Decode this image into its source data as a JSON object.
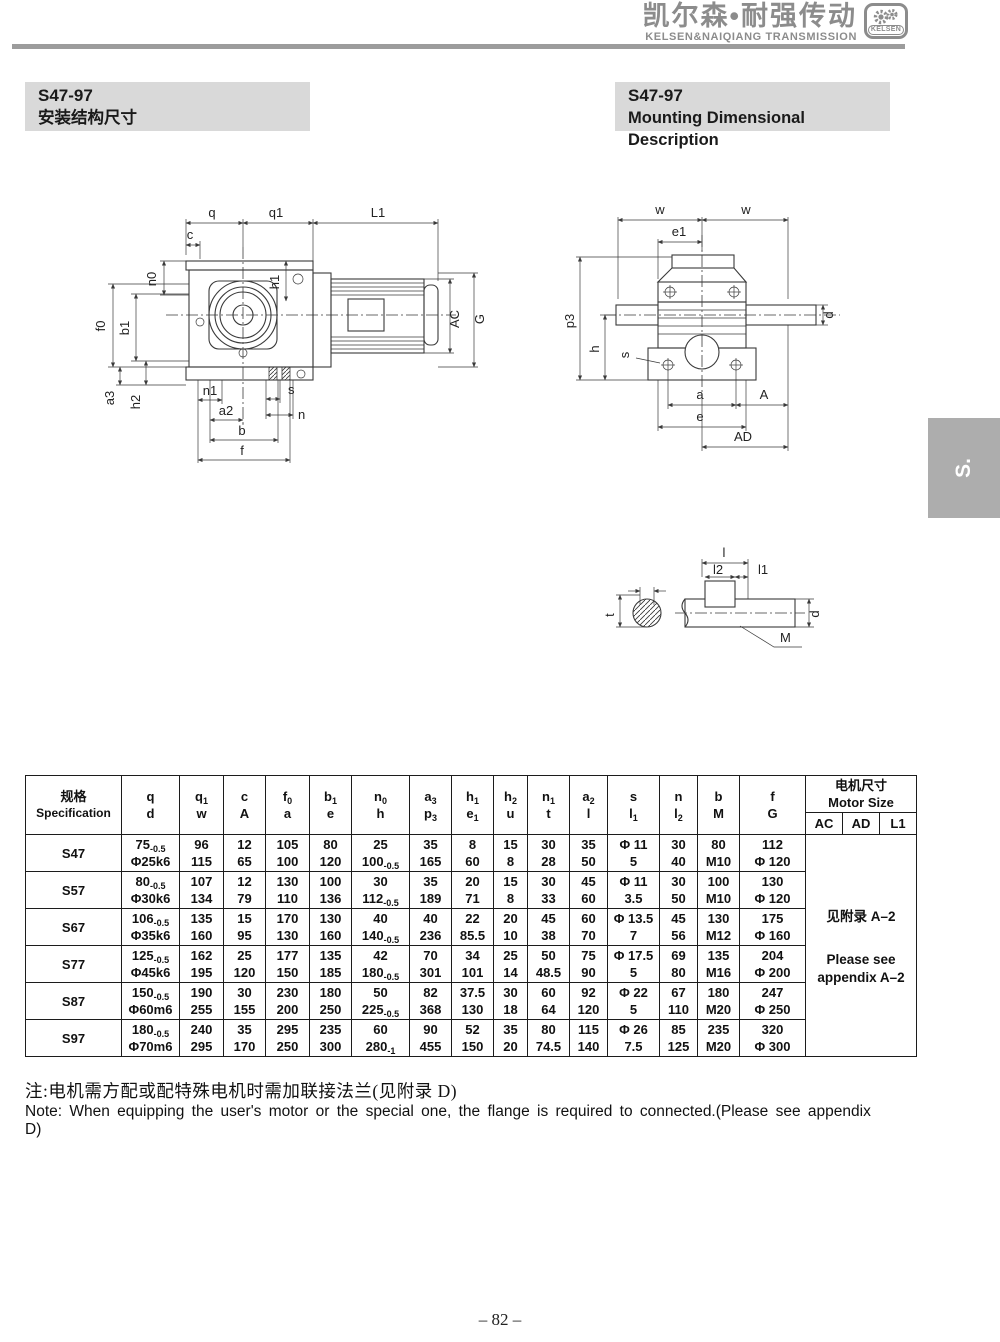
{
  "header": {
    "brand_cn": "凯尔森•耐强传动",
    "brand_en": "KELSEN&NAIQIANG TRANSMISSION",
    "logo_text": "KELSEN"
  },
  "titles": {
    "left_model": "S47-97",
    "left_subtitle": "安装结构尺寸",
    "right_model": "S47-97",
    "right_subtitle": "Mounting Dimensional Description"
  },
  "side_tab": "S.",
  "drawings": {
    "front": {
      "q": "q",
      "q1": "q1",
      "L1": "L1",
      "c": "c",
      "n0": "n0",
      "h1": "h1",
      "f0": "f0",
      "b1": "b1",
      "a3": "a3",
      "h2": "h2",
      "n1": "n1",
      "a2": "a2",
      "s": "s",
      "n": "n",
      "b": "b",
      "f": "f",
      "AC": "AC",
      "G": "G"
    },
    "side": {
      "w1": "w",
      "w2": "w",
      "e1": "e1",
      "p3": "p3",
      "h": "h",
      "s": "s",
      "d": "d",
      "a": "a",
      "A": "A",
      "e": "e",
      "AD": "AD"
    },
    "detail": {
      "l": "l",
      "l2": "l2",
      "l1": "l1",
      "t": "t",
      "d": "d",
      "M": "M"
    }
  },
  "table": {
    "spec_header": {
      "cn": "规格",
      "en": "Specification"
    },
    "columns": [
      {
        "t": "q",
        "ts": "",
        "b": "d",
        "bs": ""
      },
      {
        "t": "q",
        "ts": "1",
        "b": "w",
        "bs": ""
      },
      {
        "t": "c",
        "ts": "",
        "b": "A",
        "bs": ""
      },
      {
        "t": "f",
        "ts": "0",
        "b": "a",
        "bs": ""
      },
      {
        "t": "b",
        "ts": "1",
        "b": "e",
        "bs": ""
      },
      {
        "t": "n",
        "ts": "0",
        "b": "h",
        "bs": ""
      },
      {
        "t": "a",
        "ts": "3",
        "b": "p",
        "bs": "3"
      },
      {
        "t": "h",
        "ts": "1",
        "b": "e",
        "bs": "1"
      },
      {
        "t": "h",
        "ts": "2",
        "b": "u",
        "bs": ""
      },
      {
        "t": "n",
        "ts": "1",
        "b": "t",
        "bs": ""
      },
      {
        "t": "a",
        "ts": "2",
        "b": "l",
        "bs": ""
      },
      {
        "t": "s",
        "ts": "",
        "b": "l",
        "bs": "1"
      },
      {
        "t": "n",
        "ts": "",
        "b": "l",
        "bs": "2"
      },
      {
        "t": "b",
        "ts": "",
        "b": "M",
        "bs": ""
      },
      {
        "t": "f",
        "ts": "",
        "b": "G",
        "bs": ""
      }
    ],
    "motor_header": {
      "cn": "电机尺寸",
      "en": "Motor Size",
      "cols": [
        "AC",
        "AD",
        "L1"
      ]
    },
    "rows": [
      {
        "spec": "S47",
        "cells": [
          {
            "t": "75",
            "ts": "-0.5",
            "b": "Φ25k6"
          },
          {
            "t": "96",
            "b": "115"
          },
          {
            "t": "12",
            "b": "65"
          },
          {
            "t": "105",
            "b": "100"
          },
          {
            "t": "80",
            "b": "120"
          },
          {
            "t": "25",
            "b": "100",
            "bs": "-0.5"
          },
          {
            "t": "35",
            "b": "165"
          },
          {
            "t": "8",
            "b": "60"
          },
          {
            "t": "15",
            "b": "8"
          },
          {
            "t": "30",
            "b": "28"
          },
          {
            "t": "35",
            "b": "50"
          },
          {
            "t": "Φ 11",
            "b": "5"
          },
          {
            "t": "30",
            "b": "40"
          },
          {
            "t": "80",
            "b": "M10"
          },
          {
            "t": "112",
            "b": "Φ 120"
          }
        ]
      },
      {
        "spec": "S57",
        "cells": [
          {
            "t": "80",
            "ts": "-0.5",
            "b": "Φ30k6"
          },
          {
            "t": "107",
            "b": "134"
          },
          {
            "t": "12",
            "b": "79"
          },
          {
            "t": "130",
            "b": "110"
          },
          {
            "t": "100",
            "b": "136"
          },
          {
            "t": "30",
            "b": "112",
            "bs": "-0.5"
          },
          {
            "t": "35",
            "b": "189"
          },
          {
            "t": "20",
            "b": "71"
          },
          {
            "t": "15",
            "b": "8"
          },
          {
            "t": "30",
            "b": "33"
          },
          {
            "t": "45",
            "b": "60"
          },
          {
            "t": "Φ 11",
            "b": "3.5"
          },
          {
            "t": "30",
            "b": "50"
          },
          {
            "t": "100",
            "b": "M10"
          },
          {
            "t": "130",
            "b": "Φ 120"
          }
        ]
      },
      {
        "spec": "S67",
        "cells": [
          {
            "t": "106",
            "ts": "-0.5",
            "b": "Φ35k6"
          },
          {
            "t": "135",
            "b": "160"
          },
          {
            "t": "15",
            "b": "95"
          },
          {
            "t": "170",
            "b": "130"
          },
          {
            "t": "130",
            "b": "160"
          },
          {
            "t": "40",
            "b": "140",
            "bs": "-0.5"
          },
          {
            "t": "40",
            "b": "236"
          },
          {
            "t": "22",
            "b": "85.5"
          },
          {
            "t": "20",
            "b": "10"
          },
          {
            "t": "45",
            "b": "38"
          },
          {
            "t": "60",
            "b": "70"
          },
          {
            "t": "Φ 13.5",
            "b": "7"
          },
          {
            "t": "45",
            "b": "56"
          },
          {
            "t": "130",
            "b": "M12"
          },
          {
            "t": "175",
            "b": "Φ 160"
          }
        ]
      },
      {
        "spec": "S77",
        "cells": [
          {
            "t": "125",
            "ts": "-0.5",
            "b": "Φ45k6"
          },
          {
            "t": "162",
            "b": "195"
          },
          {
            "t": "25",
            "b": "120"
          },
          {
            "t": "177",
            "b": "150"
          },
          {
            "t": "135",
            "b": "185"
          },
          {
            "t": "42",
            "b": "180",
            "bs": "-0.5"
          },
          {
            "t": "70",
            "b": "301"
          },
          {
            "t": "34",
            "b": "101"
          },
          {
            "t": "25",
            "b": "14"
          },
          {
            "t": "50",
            "b": "48.5"
          },
          {
            "t": "75",
            "b": "90"
          },
          {
            "t": "Φ 17.5",
            "b": "5"
          },
          {
            "t": "69",
            "b": "80"
          },
          {
            "t": "135",
            "b": "M16"
          },
          {
            "t": "204",
            "b": "Φ 200"
          }
        ]
      },
      {
        "spec": "S87",
        "cells": [
          {
            "t": "150",
            "ts": "-0.5",
            "b": "Φ60m6"
          },
          {
            "t": "190",
            "b": "255"
          },
          {
            "t": "30",
            "b": "155"
          },
          {
            "t": "230",
            "b": "200"
          },
          {
            "t": "180",
            "b": "250"
          },
          {
            "t": "50",
            "b": "225",
            "bs": "-0.5"
          },
          {
            "t": "82",
            "b": "368"
          },
          {
            "t": "37.5",
            "b": "130"
          },
          {
            "t": "30",
            "b": "18"
          },
          {
            "t": "60",
            "b": "64"
          },
          {
            "t": "92",
            "b": "120"
          },
          {
            "t": "Φ 22",
            "b": "5"
          },
          {
            "t": "67",
            "b": "110"
          },
          {
            "t": "180",
            "b": "M20"
          },
          {
            "t": "247",
            "b": "Φ 250"
          }
        ]
      },
      {
        "spec": "S97",
        "cells": [
          {
            "t": "180",
            "ts": "-0.5",
            "b": "Φ70m6"
          },
          {
            "t": "240",
            "b": "295"
          },
          {
            "t": "35",
            "b": "170"
          },
          {
            "t": "295",
            "b": "250"
          },
          {
            "t": "235",
            "b": "300"
          },
          {
            "t": "60",
            "b": "280",
            "bs": "-1"
          },
          {
            "t": "90",
            "b": "455"
          },
          {
            "t": "52",
            "b": "150"
          },
          {
            "t": "35",
            "b": "20"
          },
          {
            "t": "80",
            "b": "74.5"
          },
          {
            "t": "115",
            "b": "140"
          },
          {
            "t": "Φ 26",
            "b": "7.5"
          },
          {
            "t": "85",
            "b": "125"
          },
          {
            "t": "235",
            "b": "M20"
          },
          {
            "t": "320",
            "b": "Φ 300"
          }
        ]
      }
    ],
    "motor_note_cn": "见附录 A–2",
    "motor_note_en": "Please see appendix A–2"
  },
  "notes": {
    "cn": "注:电机需方配或配特殊电机时需加联接法兰(见附录 D)",
    "en": "Note: When equipping the user's motor or the special one, the flange is required to connected.(Please see appendix D)"
  },
  "page_number": "– 82 –"
}
